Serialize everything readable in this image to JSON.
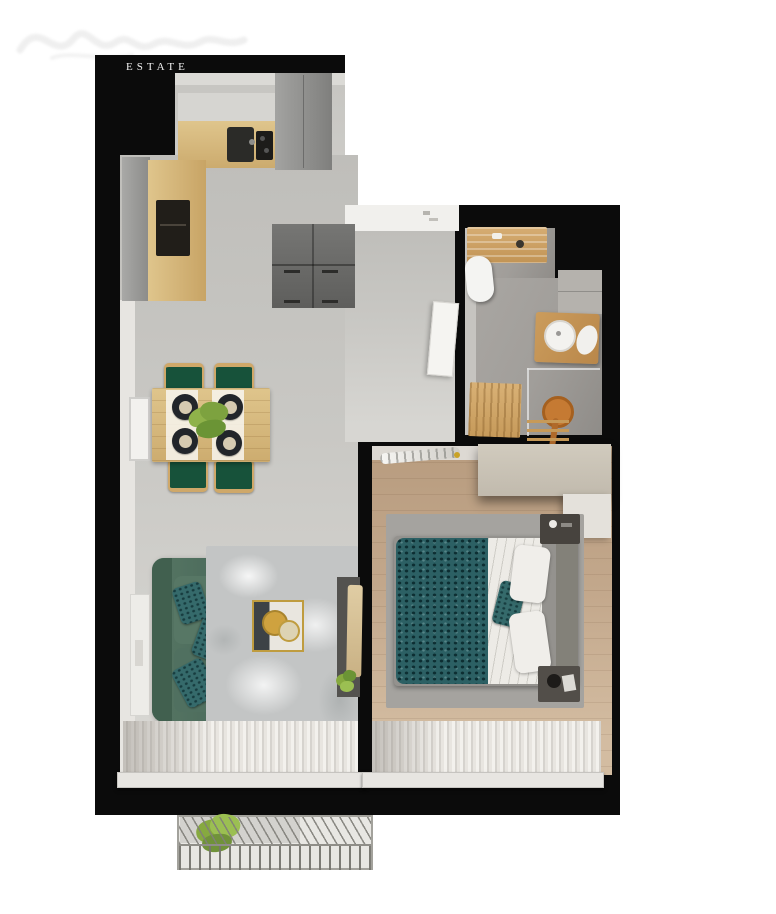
{
  "brand": {
    "estate_label": "ESTATE"
  },
  "palette": {
    "wall_black": "#0b0b0b",
    "concrete_floor": "#c9c8c4",
    "wood_floor": "#c3a88c",
    "bath_floor": "#a19e9a",
    "counter_wood": "#d9bd8a",
    "cabinet_gray": "#8e8e8c",
    "cabinet_dark": "#666664",
    "sofa_green": "#4f7161",
    "pillow_teal": "#356a6b",
    "duvet_teal": "#2c6064",
    "chair_green": "#17523a",
    "chair_wood": "#cfa869",
    "rug_gray": "#a5a39f",
    "rug_marble": "#c3c5c5",
    "wardrobe_greige": "#cbc5b8",
    "curtain_white": "#e8e5e0",
    "copper": "#b06a2a",
    "gold": "#c9a227",
    "plant_green": "#86a93f"
  }
}
